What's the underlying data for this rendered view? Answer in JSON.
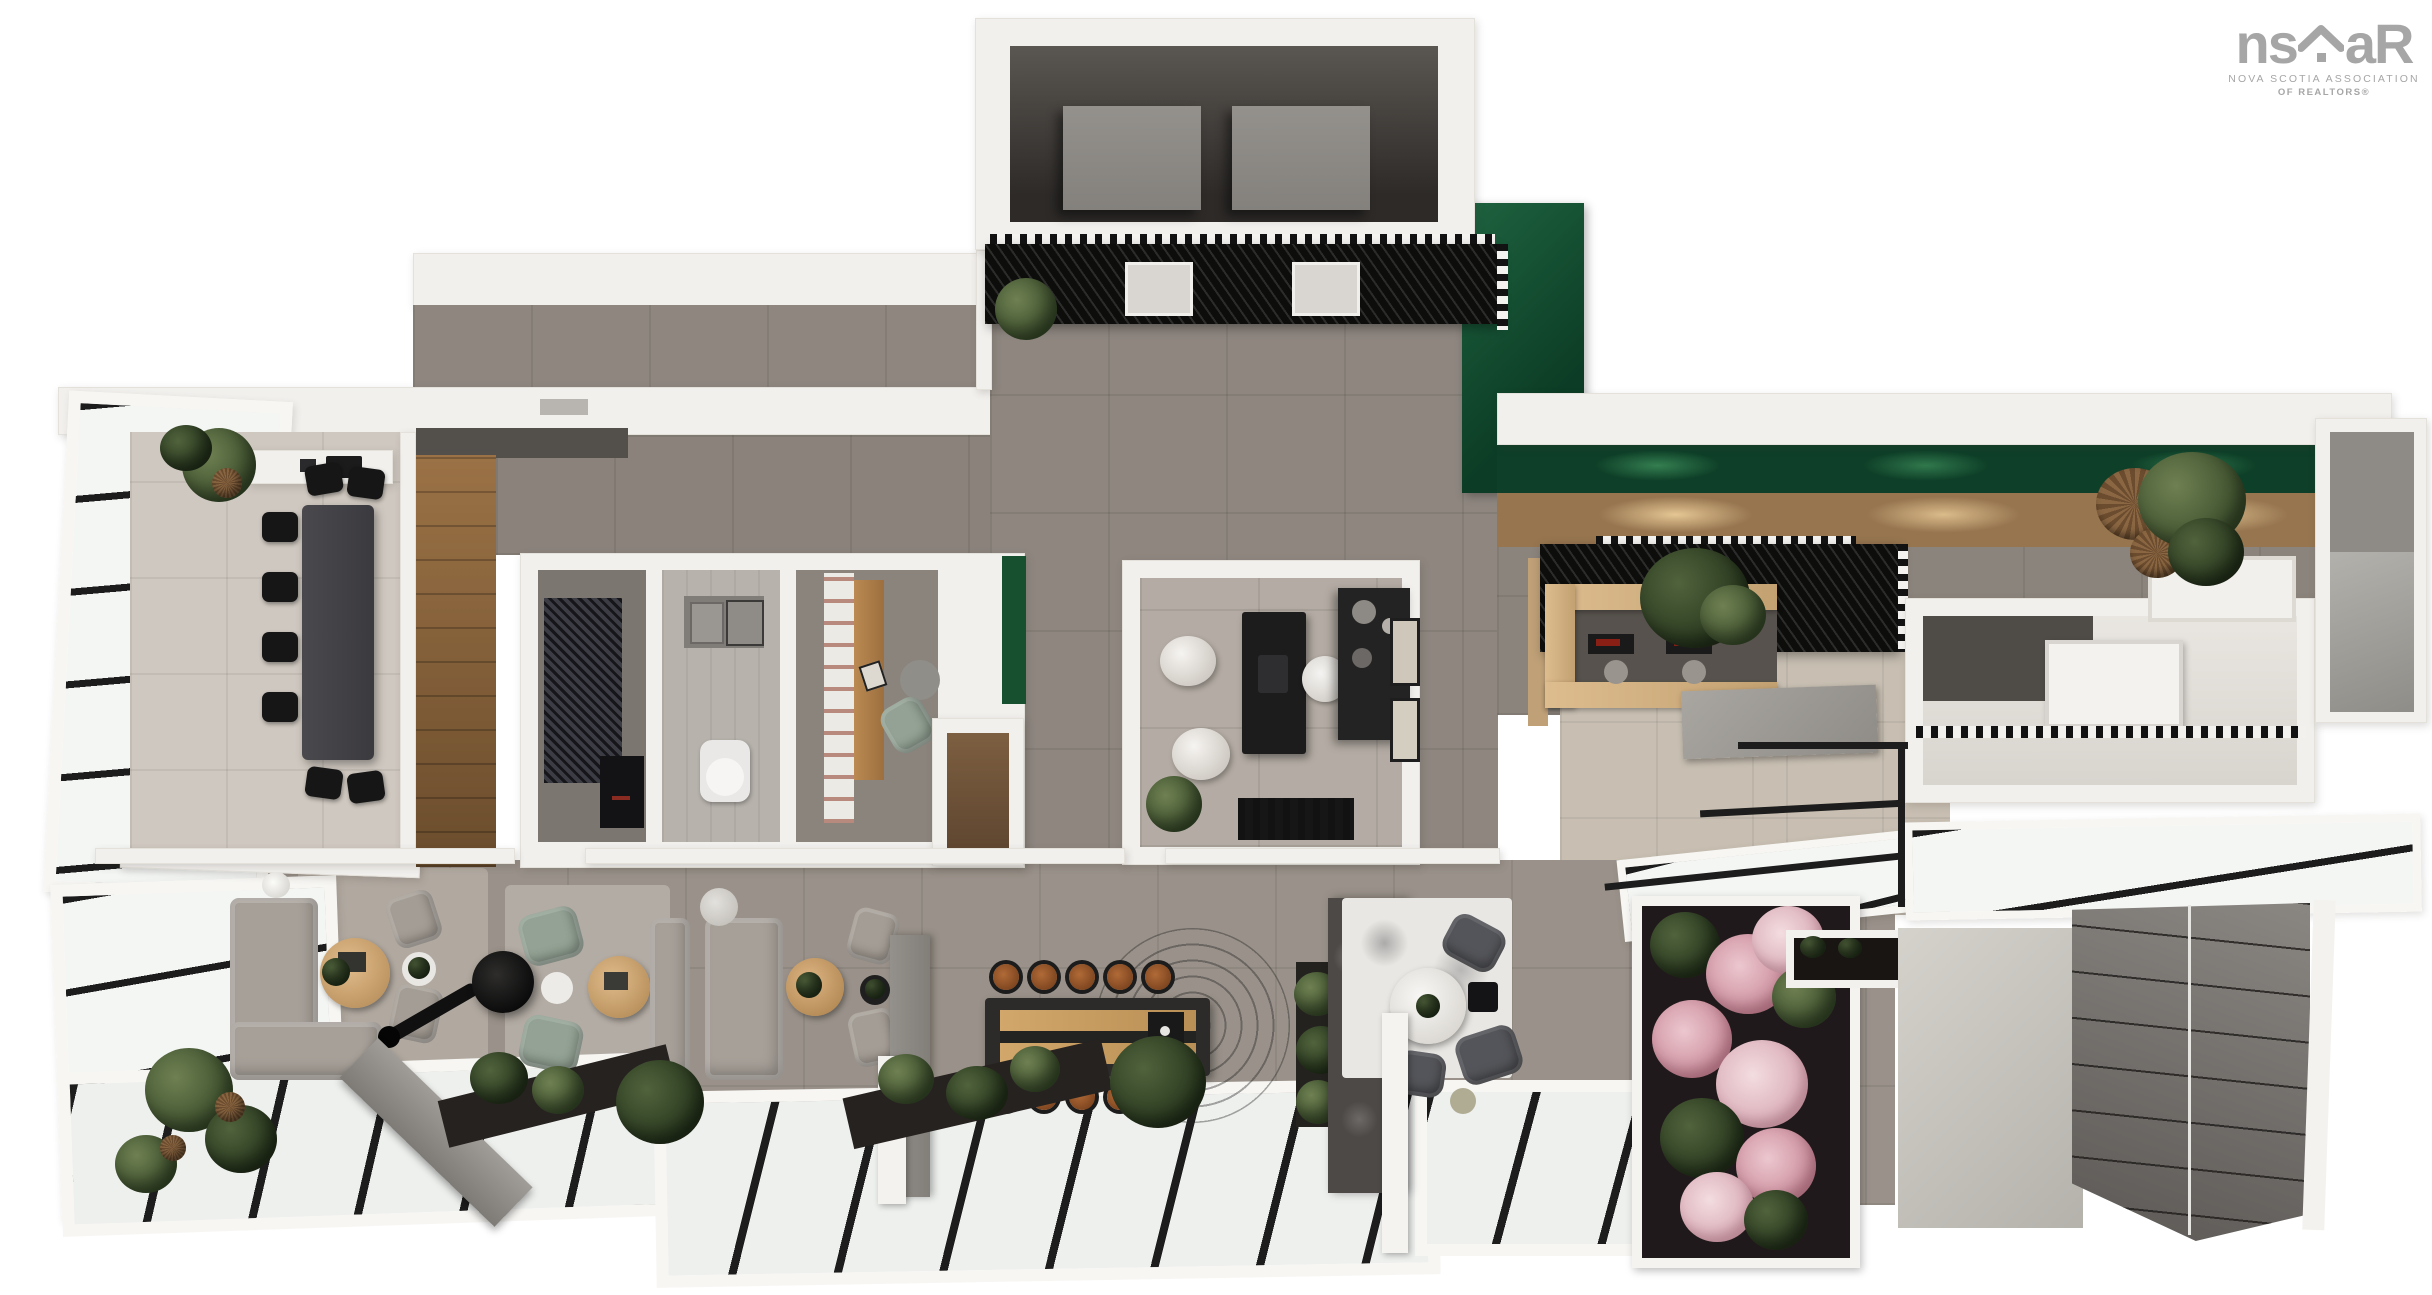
{
  "page": {
    "width_px": 2432,
    "height_px": 1295,
    "background": "#ffffff"
  },
  "logo": {
    "text_ns": "ns",
    "text_ar": "aR",
    "subtitle_line1": "NOVA SCOTIA ASSOCIATION",
    "subtitle_line2": "OF REALTORS®",
    "color": "#a6a6a6",
    "house_icon": "house-roof-icon"
  },
  "render": {
    "kind": "3D top-down architectural floor plan rendering",
    "palette": {
      "outer_wall_white": "#f2f0ed",
      "hall_floor_gray": "#8e867f",
      "beige_tile": "#c8bfb2",
      "wood_floor": "#8a6038",
      "oak_counter": "#d9b688",
      "accent_green_wall": "#14532d",
      "plant_green": "#45572f",
      "black_canopy": "#111111",
      "glass_white": "#f4f6f4",
      "mullion_black": "#1a1a1a",
      "concrete": "#ccc9c3",
      "garage_panels": "#77736f",
      "pink_flowers": "#d9aab4",
      "cognac_leather": "#9c5a30",
      "sage_chair": "#93a294",
      "sofa_gray": "#a7a099",
      "charcoal_table": "#434246"
    },
    "zones": [
      {
        "id": "mechanical-room",
        "label": "rooftop mechanical room with two elevator shafts"
      },
      {
        "id": "entry-canopy",
        "label": "black slatted entry canopy with elevator doors"
      },
      {
        "id": "green-feature-wall",
        "label": "dark green L-shaped feature wall"
      },
      {
        "id": "entry-hall",
        "label": "gray tiled entry hall"
      },
      {
        "id": "conference-room",
        "label": "glass-walled conference room"
      },
      {
        "id": "utility-room",
        "label": "utility room with black cabinet"
      },
      {
        "id": "bathroom",
        "label": "bathroom with vanity and toilet"
      },
      {
        "id": "study",
        "label": "study with wood desk, shelving and armchair"
      },
      {
        "id": "private-office",
        "label": "private office with black desk and guest poufs"
      },
      {
        "id": "reception",
        "label": "oak reception counter under slatted canopy"
      },
      {
        "id": "right-suite",
        "label": "right suite with dark accent wall and doors"
      },
      {
        "id": "stair-void",
        "label": "stair void with black railing and concrete landing"
      },
      {
        "id": "lounge",
        "label": "lounge with sectional sofa and suspended fireplace"
      },
      {
        "id": "seating-group",
        "label": "facing sofas seating group"
      },
      {
        "id": "bar",
        "label": "bar island with cognac stools"
      },
      {
        "id": "dining-nook",
        "label": "dining nook with round white table"
      },
      {
        "id": "flower-garden",
        "label": "pink flowering garden planter"
      },
      {
        "id": "patio",
        "label": "concrete patio"
      },
      {
        "id": "garage",
        "label": "dark paneled garage slope"
      },
      {
        "id": "skylights",
        "label": "diagonal glass skylight roof strips"
      }
    ],
    "furniture_counts": {
      "conference_chairs": 8,
      "bar_stools": 10,
      "dining_chairs": 3,
      "sofas": 3,
      "armchairs": 6,
      "guest_poufs": 2,
      "elevator_shafts": 2,
      "reception_workstations": 2,
      "framed_artworks": 2
    }
  }
}
